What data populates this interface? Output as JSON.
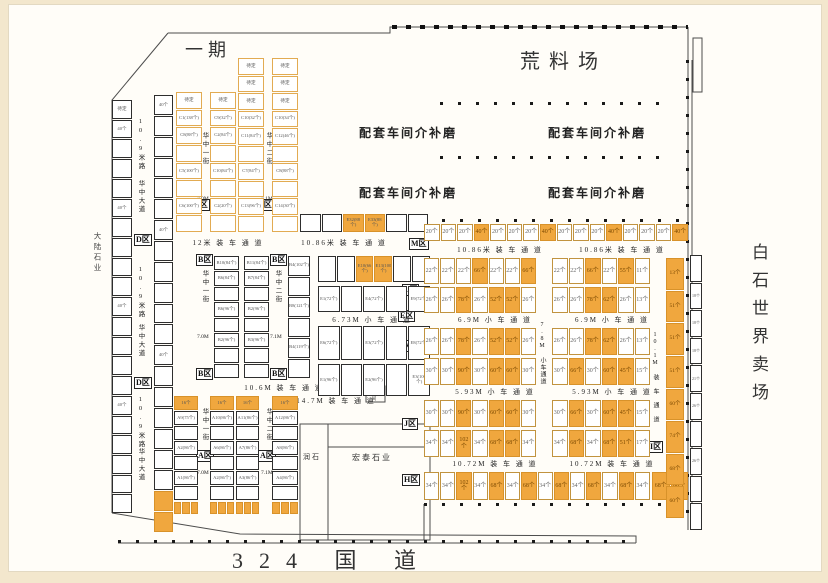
{
  "titles": {
    "phase": "一期",
    "yard": "荒料场",
    "market": "白石世界卖场",
    "road": "324 国 道",
    "left_company": "大陆石业",
    "workshop": "配套车间介补磨",
    "runshi": "润石",
    "hongtai": "宏泰石业",
    "toilet": "卫生间"
  },
  "zones": {
    "a": "A区",
    "b": "B区",
    "c": "C区",
    "d": "D区",
    "e": "E区",
    "h": "H区",
    "i": "I区",
    "j": "J区",
    "k": "K区",
    "l": "L区",
    "m": "M区"
  },
  "lanes": {
    "l12": "12米 装 车 通 道",
    "l1086": "10.86米 装 车 通 道",
    "l673": "6.73M 小 车 通 道",
    "l106": "10.6M 装 车 通 道",
    "l147": "14.7M 装 车 通 道",
    "l69": "6.9M 小 车 通 道",
    "l593": "5.93M 小 车 通 道",
    "l78": "7.8M 小车通道",
    "l1072": "10.72M 装 车 通 道",
    "l101": "10.1M 装 车 通 道"
  },
  "streets": {
    "r109": "10.9米路",
    "avenue": "华中大道",
    "s1": "华中一街",
    "s1w": "7.0M",
    "s2": "华中二街",
    "s2w": "7.1M"
  },
  "left_strip": [
    "待定",
    "40个",
    "",
    "",
    "",
    "40个",
    "",
    "",
    "",
    "",
    "40个",
    "",
    "",
    "",
    "",
    "40个",
    "",
    "",
    "",
    "",
    ""
  ],
  "col2_strip": [
    "40个",
    "",
    "",
    "",
    "",
    "",
    "40个",
    "",
    "",
    "",
    "",
    "",
    "40个",
    "",
    "",
    "",
    "",
    "",
    "",
    {
      "hl": true
    },
    {
      "hl": true
    }
  ],
  "c_cols": {
    "c1": [
      "待定",
      "C1(138个)",
      "C8(88个)",
      "",
      "C5(100个)",
      "",
      "C6(100个)",
      ""
    ],
    "c2": [
      "待定",
      "C9(32个)",
      "C2(84个)",
      "",
      "C10(84个)",
      "",
      "C2(20个)",
      ""
    ],
    "c3": [
      "待定",
      "待定",
      "待定",
      "C10(32个)",
      "C11(84个)",
      "",
      "C7(84个)",
      "",
      "C13(96个)",
      ""
    ],
    "c4": [
      "待定",
      "待定",
      "待定",
      "C10(34个)",
      "C12(46个)",
      "",
      "C8(88个)",
      "",
      "C14(30个)",
      ""
    ]
  },
  "c_row_bottom": [
    {
      "t": ""
    },
    {
      "t": ""
    },
    {
      "t": "E32(88个)",
      "hl": true
    },
    {
      "t": "E33(88个)",
      "hl": true
    },
    {
      "t": ""
    },
    {
      "t": ""
    }
  ],
  "b_cols": {
    "b1": [
      "B10(84个)",
      "B6(84个)",
      "",
      "B6(96个)",
      "",
      "B2(96个)",
      "",
      ""
    ],
    "b2": [
      "B11(84个)",
      "B7(84个)",
      "",
      "B2(96个)",
      "",
      "B3(96个)",
      "",
      ""
    ],
    "b3": [
      "B4(102个)",
      "",
      "B8(121个)",
      "",
      "B4(119个)",
      ""
    ]
  },
  "e_rows": {
    "r0": [
      {
        "t": ""
      },
      {
        "t": ""
      },
      {
        "t": "E10(66个)",
        "hl": true
      },
      {
        "t": "E13(100个)",
        "hl": true
      },
      {
        "t": ""
      },
      {
        "t": ""
      }
    ],
    "r1": [
      "E1(72个)",
      "",
      "E4(72个)",
      "",
      "E9(72个)"
    ],
    "r2": [
      "E6(72个)",
      "",
      "E3(72个)",
      "",
      "E8(72个)"
    ],
    "r3": [
      "E1(96个)",
      "",
      "E2(96个)",
      "",
      "E3(100个)"
    ]
  },
  "a_cols": {
    "a1": [
      {
        "t": "16个",
        "hl": true
      },
      "A9(75个)",
      "",
      "A2(86个)",
      "",
      "A1(86个)",
      ""
    ],
    "a2": [
      {
        "t": "16个",
        "hl": true
      },
      "A10(86个)",
      "",
      "A6(86个)",
      "",
      "A2(86个)",
      ""
    ],
    "a3": [
      {
        "t": "16个",
        "hl": true
      },
      "A11(86个)",
      "",
      "A7(86个)",
      "",
      "A3(86个)",
      ""
    ],
    "a4": [
      {
        "t": "16个",
        "hl": true
      },
      "A12(86个)",
      "",
      "A8(86个)",
      "",
      "A4(86个)",
      ""
    ]
  },
  "a_foot": [
    {
      "hl": true
    },
    {
      "hl": true
    },
    {
      "hl": true
    }
  ],
  "m_row": [
    {
      "t": "20个"
    },
    {
      "t": "20个"
    },
    {
      "t": "20个"
    },
    {
      "t": "40个",
      "hl": true
    },
    {
      "t": "20个"
    },
    {
      "t": "20个"
    },
    {
      "t": "20个"
    },
    {
      "t": "40个",
      "hl": true
    },
    {
      "t": "20个"
    },
    {
      "t": "20个"
    },
    {
      "t": "20个"
    },
    {
      "t": "40个",
      "hl": true
    },
    {
      "t": "20个"
    },
    {
      "t": "20个"
    },
    {
      "t": "20个"
    },
    {
      "t": "40个",
      "hl": true
    }
  ],
  "l_rows": {
    "r1L": [
      {
        "t": "22个"
      },
      {
        "t": "22个"
      },
      {
        "t": "22个"
      },
      {
        "t": "66个",
        "hl": true
      },
      {
        "t": "22个"
      },
      {
        "t": "22个"
      },
      {
        "t": "66个",
        "hl": true
      }
    ],
    "r1R": [
      {
        "t": "22个"
      },
      {
        "t": "22个"
      },
      {
        "t": "66个",
        "hl": true
      },
      {
        "t": "22个"
      },
      {
        "t": "55个",
        "hl": true
      },
      {
        "t": "11个"
      }
    ],
    "r2L": [
      {
        "t": "26个"
      },
      {
        "t": "26个"
      },
      {
        "t": "78个",
        "hl": true
      },
      {
        "t": "26个"
      },
      {
        "t": "52个",
        "hl": true
      },
      {
        "t": "52个",
        "hl": true
      },
      {
        "t": "26个"
      }
    ],
    "r2R": [
      {
        "t": "26个"
      },
      {
        "t": "26个"
      },
      {
        "t": "78个",
        "hl": true
      },
      {
        "t": "62个",
        "hl": true
      },
      {
        "t": "26个"
      },
      {
        "t": "13个"
      }
    ]
  },
  "k_rows": {
    "r1L": [
      {
        "t": "26个"
      },
      {
        "t": "26个"
      },
      {
        "t": "78个",
        "hl": true
      },
      {
        "t": "26个"
      },
      {
        "t": "52个",
        "hl": true
      },
      {
        "t": "52个",
        "hl": true
      },
      {
        "t": "26个"
      }
    ],
    "r1R": [
      {
        "t": "26个"
      },
      {
        "t": "26个"
      },
      {
        "t": "78个",
        "hl": true
      },
      {
        "t": "62个",
        "hl": true
      },
      {
        "t": "26个"
      },
      {
        "t": "13个"
      }
    ],
    "r2L": [
      {
        "t": "30个"
      },
      {
        "t": "30个"
      },
      {
        "t": "90个",
        "hl": true
      },
      {
        "t": "30个"
      },
      {
        "t": "60个",
        "hl": true
      },
      {
        "t": "60个",
        "hl": true
      },
      {
        "t": "30个"
      }
    ],
    "r2R": [
      {
        "t": "30个"
      },
      {
        "t": "66个",
        "hl": true
      },
      {
        "t": "30个"
      },
      {
        "t": "60个",
        "hl": true
      },
      {
        "t": "45个",
        "hl": true
      },
      {
        "t": "15个"
      }
    ]
  },
  "j_rows": {
    "r1L": [
      {
        "t": "30个"
      },
      {
        "t": "30个"
      },
      {
        "t": "90个",
        "hl": true
      },
      {
        "t": "30个"
      },
      {
        "t": "60个",
        "hl": true
      },
      {
        "t": "60个",
        "hl": true
      },
      {
        "t": "30个"
      }
    ],
    "r1R": [
      {
        "t": "30个"
      },
      {
        "t": "66个",
        "hl": true
      },
      {
        "t": "30个"
      },
      {
        "t": "60个",
        "hl": true
      },
      {
        "t": "45个",
        "hl": true
      },
      {
        "t": "15个"
      }
    ],
    "r2L": [
      {
        "t": "34个"
      },
      {
        "t": "34个"
      },
      {
        "t": "102个",
        "hl": true
      },
      {
        "t": "34个"
      },
      {
        "t": "68个",
        "hl": true
      },
      {
        "t": "68个",
        "hl": true
      },
      {
        "t": "34个"
      }
    ],
    "r2R": [
      {
        "t": "34个"
      },
      {
        "t": "68个",
        "hl": true
      },
      {
        "t": "34个"
      },
      {
        "t": "68个",
        "hl": true
      },
      {
        "t": "51个",
        "hl": true
      },
      {
        "t": "17个"
      }
    ]
  },
  "h_row": [
    {
      "t": "34个"
    },
    {
      "t": "34个"
    },
    {
      "t": "102个",
      "hl": true
    },
    {
      "t": "34个"
    },
    {
      "t": "68个",
      "hl": true
    },
    {
      "t": "34个"
    },
    {
      "t": "68个",
      "hl": true
    },
    {
      "t": "34个"
    },
    {
      "t": "68个",
      "hl": true
    },
    {
      "t": "34个"
    },
    {
      "t": "68个",
      "hl": true
    },
    {
      "t": "34个"
    },
    {
      "t": "68个",
      "hl": true
    },
    {
      "t": "34个"
    }
  ],
  "h_end": [
    {
      "t": "68个",
      "hl": true
    },
    {
      "t": "60个",
      "hl": true
    }
  ],
  "right_strip": [
    {
      "t": "13个",
      "hl": true
    },
    {
      "t": "51个",
      "hl": true
    },
    {
      "t": "51个",
      "hl": true
    },
    {
      "t": "51个",
      "hl": true
    },
    {
      "t": "60个",
      "hl": true
    },
    {
      "t": "74个",
      "hl": true
    },
    {
      "t": "68个",
      "hl": true
    },
    {
      "t": "60个",
      "hl": true
    }
  ],
  "outer_strip": [
    "",
    "18个",
    "18个",
    "18个",
    "21个",
    "26个",
    "",
    "26个",
    "",
    ""
  ]
}
